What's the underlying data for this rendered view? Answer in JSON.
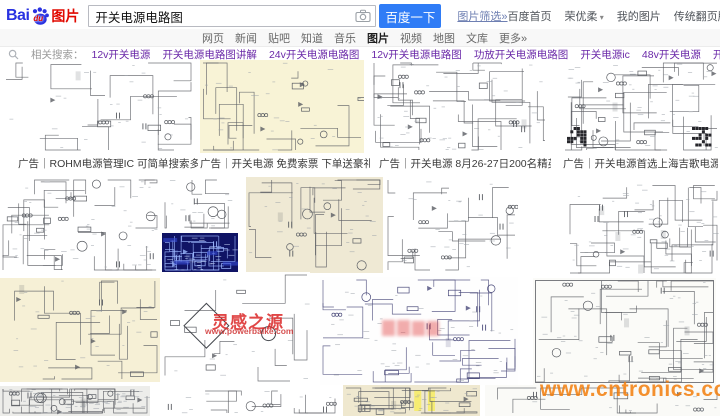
{
  "header": {
    "logo_bai": "Bai",
    "logo_du": "du",
    "logo_suffix": "图片",
    "search_value": "开关电源电路图",
    "search_button": "百度一下",
    "filter_link": "图片筛选»",
    "top_links": [
      "百度首页",
      "荣优柔",
      "我的图片",
      "传统翻页版本"
    ]
  },
  "nav": {
    "tabs": [
      "网页",
      "新闻",
      "贴吧",
      "知道",
      "音乐",
      "图片",
      "视频",
      "地图",
      "文库",
      "更多»"
    ],
    "active": "图片"
  },
  "related": {
    "label": "相关搜索：",
    "terms": [
      "12v开关电源",
      "开关电源电路图讲解",
      "24v开关电源电路图",
      "12v开关电源电路图",
      "功放开关电源电路图",
      "开关电源ic",
      "48v开关电源",
      "开关电源电路图详解",
      "380v开关电源电路图"
    ]
  },
  "ads": {
    "captions": [
      "广告｜ROHM电源管理IC 可简单搜索多种产品线!",
      "广告｜开关电源 免费索票 下单送豪礼",
      "广告｜开关电源 8月26-27日200名精英设计师等...",
      "广告｜开关电源首选上海吉歌电源科技有..."
    ]
  },
  "watermarks": {
    "powerbaike_title": "灵感之源",
    "powerbaike_url": "www.powerbaike.com",
    "cntronics": "www.cntronics.com"
  },
  "colors": {
    "brand_blue": "#2932e1",
    "brand_red": "#e10900",
    "button_blue": "#2f7cf6",
    "link_purple": "#6a28a8",
    "watermark_orange": "#f27d0a",
    "watermark_red": "#dc2d2d",
    "blueprint_navy": "#101465"
  }
}
